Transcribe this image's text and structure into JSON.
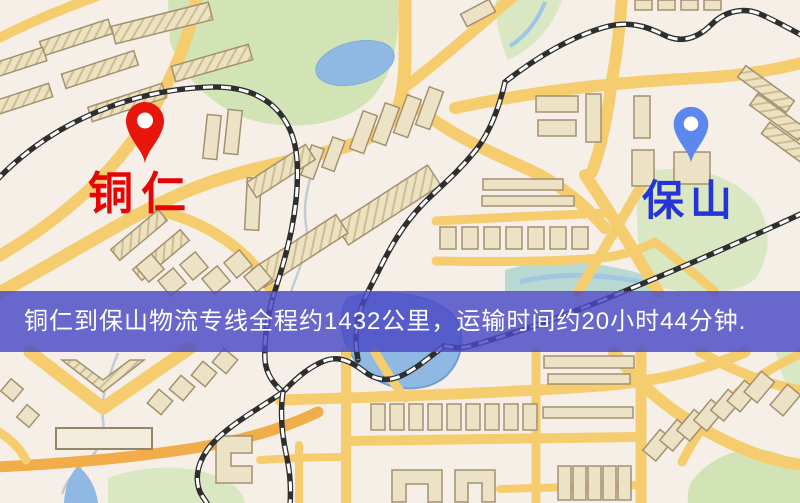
{
  "map": {
    "markers": [
      {
        "id": "origin",
        "name": "铜仁",
        "pin_color": "#e8150b",
        "label_color": "#e60505"
      },
      {
        "id": "destination",
        "name": "保山",
        "pin_color": "#5b87ee",
        "label_color": "#2434d8"
      }
    ]
  },
  "banner": {
    "text": "铜仁到保山物流专线全程约1432公里，运输时间约20小时44分钟.",
    "background_color": "rgba(73,73,197,0.82)",
    "text_color": "#ffffff"
  },
  "route": {
    "origin": "铜仁",
    "destination": "保山",
    "distance_km": 1432,
    "duration_hours": 20,
    "duration_minutes": 44
  },
  "map_colors": {
    "land": "#f5efe8",
    "road": "#f6cd6e",
    "road_orange": "#f0ad4a",
    "water": "#8fb9e2",
    "park": "#d2e3b6",
    "park2": "#d9e7c2",
    "building": "#ece3c6",
    "building_stroke": "#a59070",
    "rail": "#2e2e2e"
  }
}
